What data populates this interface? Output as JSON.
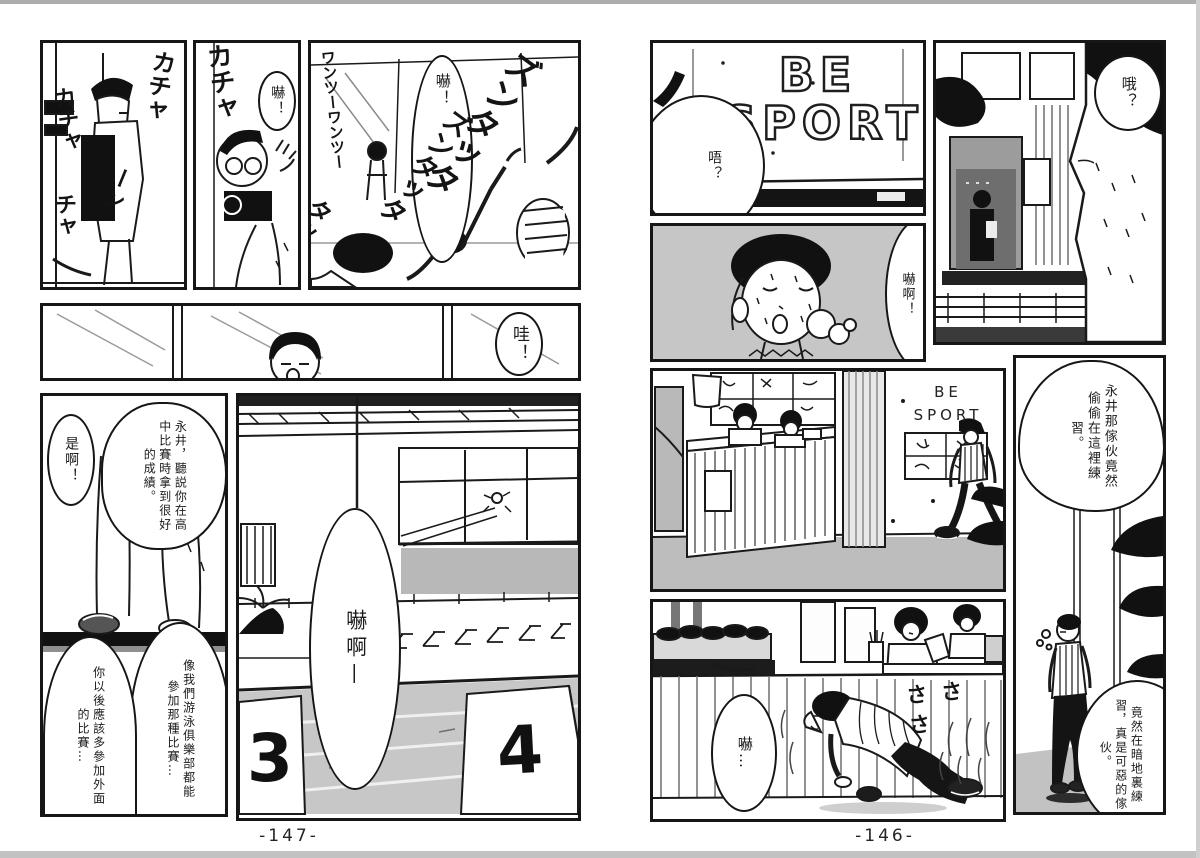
{
  "left_page": {
    "page_number": "-147-",
    "panel_gym_machine": {
      "sfx_a": "カチャ",
      "sfx_b": "カチャ",
      "sfx_c": "ーン",
      "sfx_d": "チャ"
    },
    "panel_camera_man": {
      "sfx": "カチャ",
      "bubble": "嚇！"
    },
    "panel_aerobics": {
      "bubble": "嚇！",
      "sfx_a": "ズンタッタ",
      "sfx_b": "ズンタッタ",
      "sfx_c": "ワンツーワンツー",
      "sfx_d": "タッタ"
    },
    "panel_window_strip": {
      "bubble": "哇！"
    },
    "panel_poolside_talk": {
      "bubble_nagai": "永井，聽説你在高中比賽時拿到很好的成績。",
      "bubble_yeah": "是啊！",
      "bubble_club": "像我們游泳俱樂部都能參加那種比賽…",
      "bubble_should": "你以後應該多參加外面的比賽…"
    },
    "panel_pool_hall": {
      "bubble": "嚇啊—",
      "lane_left": "3",
      "lane_right": "4"
    }
  },
  "right_page": {
    "page_number": "-146-",
    "panel_sign_wall": {
      "sign_line1": "BE",
      "sign_line2": "SPORT",
      "bubble": "唔？"
    },
    "panel_sweat_face": {
      "bubble": "嚇啊！"
    },
    "panel_profile": {
      "bubble": "哦？"
    },
    "panel_reception": {
      "sign_line1": "BE",
      "sign_line2": "SPORT"
    },
    "panel_standing_boy": {
      "bubble_top": "永井那傢伙竟然偷偷在這裡練習。",
      "bubble_bottom": "竟然在暗地裏練習，真是可惡的傢伙。"
    },
    "panel_sneak": {
      "bubble": "嚇…",
      "sfx": "さささ"
    }
  }
}
